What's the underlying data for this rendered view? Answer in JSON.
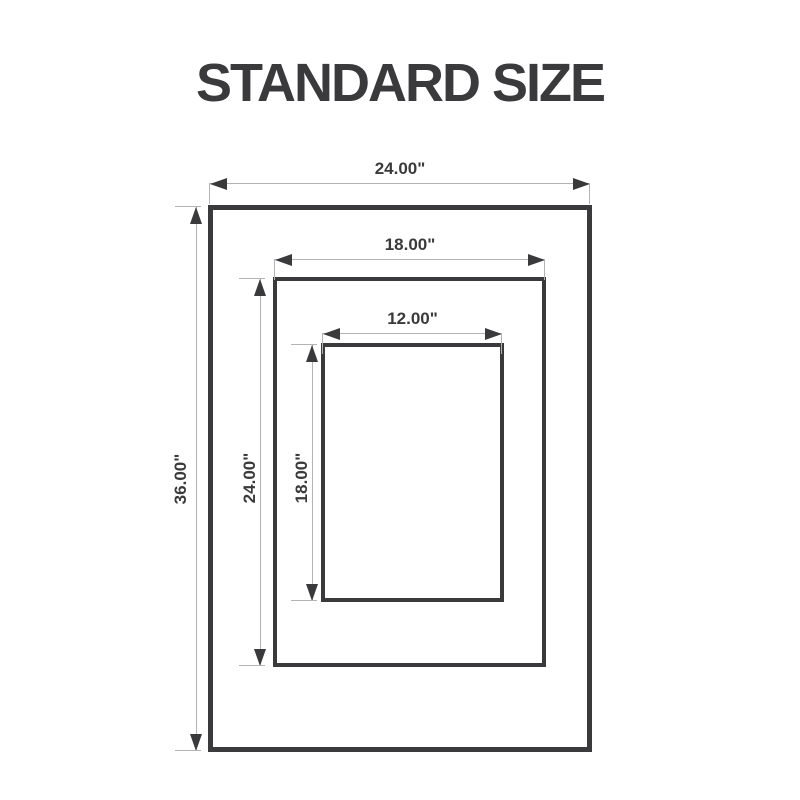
{
  "title": "STANDARD SIZE",
  "colors": {
    "ink": "#3a3a3c",
    "dimension_line": "#b3b3b3",
    "background": "#ffffff"
  },
  "diagram": {
    "type": "nested-size-dimension-diagram",
    "rects": [
      {
        "id": "outer",
        "width_label": "24.00\"",
        "height_label": "36.00\""
      },
      {
        "id": "middle",
        "width_label": "18.00\"",
        "height_label": "24.00\""
      },
      {
        "id": "inner",
        "width_label": "12.00\"",
        "height_label": "18.00\""
      }
    ]
  }
}
